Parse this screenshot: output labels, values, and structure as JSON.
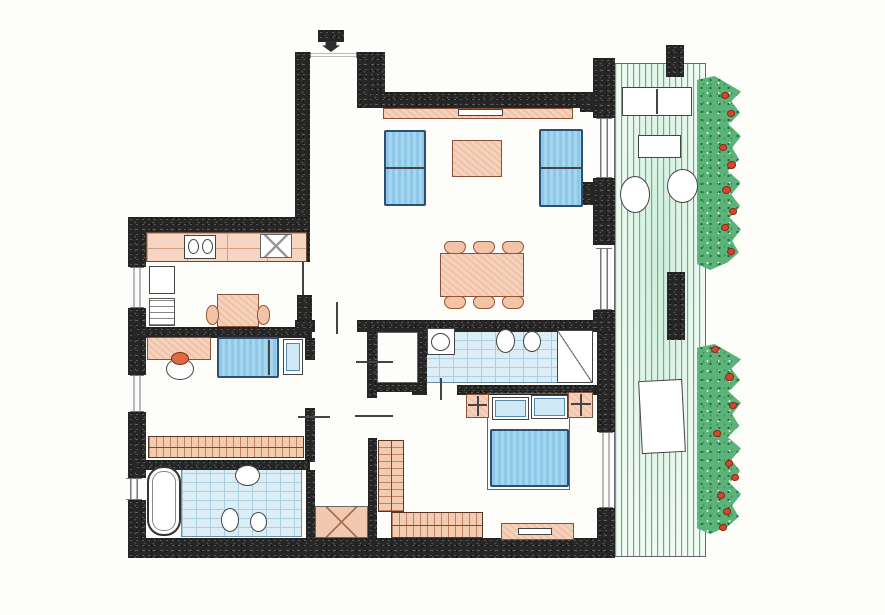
{
  "meta": {
    "title": "apartment-floor-plan",
    "canvas": {
      "width": 885,
      "height": 615
    }
  },
  "palette": {
    "paper": "#fdfdfa",
    "wall": "#262626",
    "furniture_peach": "#f6d2bc",
    "furniture_peach_border": "#8a5138",
    "upholstery_blue": "#a3d6ef",
    "upholstery_blue_border": "#2e4f74",
    "tile_blue": "#dcedf6",
    "tile_line": "#a9cfe0",
    "deck_green": "#2f9e6a",
    "hedge_green": "#5cb37a",
    "flower_red": "#d5472e",
    "glazing_gray": "#777777"
  },
  "rooms": [
    {
      "name": "entry-hall"
    },
    {
      "name": "living-dining-room"
    },
    {
      "name": "kitchen"
    },
    {
      "name": "bedroom-1"
    },
    {
      "name": "bathroom-1"
    },
    {
      "name": "hallway"
    },
    {
      "name": "closet"
    },
    {
      "name": "bathroom-2"
    },
    {
      "name": "bedroom-2"
    },
    {
      "name": "terrace"
    }
  ],
  "elements": [
    {
      "name": "terrace-deck",
      "type": "deck",
      "x": 614,
      "y": 63,
      "w": 92,
      "h": 494
    },
    {
      "name": "hedge-upper",
      "type": "hedge",
      "x": 697,
      "y": 76,
      "w": 44,
      "h": 194
    },
    {
      "name": "hedge-lower",
      "type": "hedge",
      "x": 697,
      "y": 344,
      "w": 44,
      "h": 190
    },
    {
      "name": "bathroom1-tile-floor",
      "type": "tiles",
      "x": 181,
      "y": 463,
      "w": 121,
      "h": 74
    },
    {
      "name": "bathroom2-tile-floor",
      "type": "tiles",
      "x": 424,
      "y": 330,
      "w": 137,
      "h": 53
    },
    {
      "name": "closet-floor",
      "type": "outline-thin",
      "x": 377,
      "y": 332,
      "w": 41,
      "h": 51
    },
    {
      "name": "hall-storage-x-area",
      "type": "peach-x",
      "x": 315,
      "y": 506,
      "w": 53,
      "h": 32
    },
    {
      "name": "wall-entry-left",
      "type": "wall",
      "x": 295,
      "y": 52,
      "w": 15,
      "h": 178
    },
    {
      "name": "wall-entrance-right-pillar",
      "type": "wall",
      "x": 357,
      "y": 52,
      "w": 28,
      "h": 56
    },
    {
      "name": "wall-living-top",
      "type": "wall",
      "x": 368,
      "y": 92,
      "w": 227,
      "h": 16
    },
    {
      "name": "wall-terrace-pillar-a",
      "type": "wall",
      "x": 593,
      "y": 58,
      "w": 22,
      "h": 60
    },
    {
      "name": "wall-terrace-pillar-a-stub",
      "type": "wall",
      "x": 580,
      "y": 92,
      "w": 13,
      "h": 20
    },
    {
      "name": "wall-terrace-pillar-b",
      "type": "wall",
      "x": 593,
      "y": 178,
      "w": 22,
      "h": 67
    },
    {
      "name": "wall-terrace-pillar-b-stub",
      "type": "wall",
      "x": 580,
      "y": 182,
      "w": 13,
      "h": 23
    },
    {
      "name": "wall-terrace-pillar-c",
      "type": "wall",
      "x": 593,
      "y": 310,
      "w": 22,
      "h": 22
    },
    {
      "name": "wall-kitchen-top",
      "type": "wall",
      "x": 128,
      "y": 217,
      "w": 182,
      "h": 15
    },
    {
      "name": "wall-left-1",
      "type": "wall",
      "x": 128,
      "y": 217,
      "w": 18,
      "h": 50
    },
    {
      "name": "wall-left-2",
      "type": "wall",
      "x": 128,
      "y": 308,
      "w": 18,
      "h": 67
    },
    {
      "name": "wall-left-3",
      "type": "wall",
      "x": 128,
      "y": 412,
      "w": 18,
      "h": 66
    },
    {
      "name": "wall-left-4",
      "type": "wall",
      "x": 128,
      "y": 500,
      "w": 18,
      "h": 58
    },
    {
      "name": "wall-kitchen-east-upper",
      "type": "wall",
      "x": 295,
      "y": 230,
      "w": 15,
      "h": 32
    },
    {
      "name": "wall-kitchen-east-lower",
      "type": "wall",
      "x": 297,
      "y": 295,
      "w": 15,
      "h": 32
    },
    {
      "name": "wall-kitchen-divider",
      "type": "wall",
      "x": 135,
      "y": 327,
      "w": 177,
      "h": 11
    },
    {
      "name": "wall-hall-top-left",
      "type": "wall",
      "x": 295,
      "y": 320,
      "w": 20,
      "h": 12
    },
    {
      "name": "wall-hall-top-right",
      "type": "wall",
      "x": 357,
      "y": 320,
      "w": 238,
      "h": 12
    },
    {
      "name": "wall-hall-left-upper",
      "type": "wall",
      "x": 305,
      "y": 338,
      "w": 10,
      "h": 22
    },
    {
      "name": "wall-hall-left-mid",
      "type": "wall",
      "x": 305,
      "y": 408,
      "w": 10,
      "h": 54
    },
    {
      "name": "wall-bathroom1-top",
      "type": "wall",
      "x": 135,
      "y": 460,
      "w": 175,
      "h": 10
    },
    {
      "name": "wall-bathroom1-right",
      "type": "wall",
      "x": 306,
      "y": 470,
      "w": 9,
      "h": 68
    },
    {
      "name": "wall-closet-left",
      "type": "wall",
      "x": 367,
      "y": 332,
      "w": 10,
      "h": 66
    },
    {
      "name": "wall-closet-bottom",
      "type": "wall",
      "x": 372,
      "y": 383,
      "w": 50,
      "h": 9
    },
    {
      "name": "wall-closet-right",
      "type": "wall",
      "x": 418,
      "y": 325,
      "w": 9,
      "h": 62
    },
    {
      "name": "wall-hall-right-lower",
      "type": "wall",
      "x": 368,
      "y": 438,
      "w": 9,
      "h": 100
    },
    {
      "name": "wall-bath2-bottom-left",
      "type": "wall",
      "x": 412,
      "y": 383,
      "w": 15,
      "h": 12
    },
    {
      "name": "wall-bath2-bottom-right",
      "type": "wall",
      "x": 457,
      "y": 385,
      "w": 140,
      "h": 10
    },
    {
      "name": "wall-right-lower-1",
      "type": "wall",
      "x": 597,
      "y": 332,
      "w": 18,
      "h": 100
    },
    {
      "name": "wall-right-lower-2",
      "type": "wall",
      "x": 597,
      "y": 508,
      "w": 18,
      "h": 50
    },
    {
      "name": "wall-bottom",
      "type": "wall",
      "x": 128,
      "y": 538,
      "w": 487,
      "h": 20
    },
    {
      "name": "wall-terrace-pillar-top",
      "type": "wall",
      "x": 666,
      "y": 45,
      "w": 18,
      "h": 32
    },
    {
      "name": "wall-terrace-pillar-mid",
      "type": "wall",
      "x": 667,
      "y": 272,
      "w": 18,
      "h": 68
    },
    {
      "name": "entrance-hatch-mark",
      "type": "wall",
      "x": 318,
      "y": 30,
      "w": 26,
      "h": 12
    },
    {
      "name": "kitchen-window",
      "type": "window-v",
      "x": 130,
      "y": 267,
      "w": 14,
      "h": 41
    },
    {
      "name": "bedroom1-window",
      "type": "window-v",
      "x": 130,
      "y": 375,
      "w": 14,
      "h": 37
    },
    {
      "name": "bathroom1-window",
      "type": "window-v",
      "x": 126,
      "y": 478,
      "w": 16,
      "h": 22
    },
    {
      "name": "living-terrace-door-1",
      "type": "window-v",
      "x": 596,
      "y": 118,
      "w": 16,
      "h": 60
    },
    {
      "name": "living-terrace-door-2",
      "type": "window-v",
      "x": 596,
      "y": 248,
      "w": 16,
      "h": 62
    },
    {
      "name": "bedroom2-window",
      "type": "window-v",
      "x": 599,
      "y": 432,
      "w": 14,
      "h": 76
    },
    {
      "name": "entrance-threshold",
      "type": "window-h",
      "x": 310,
      "y": 52,
      "w": 47,
      "h": 6
    },
    {
      "name": "kitchen-door-leaf",
      "type": "line-v",
      "x": 302,
      "y": 262,
      "w": 2,
      "h": 33
    },
    {
      "name": "entrance-arrow",
      "type": "arrow",
      "x": 322,
      "y": 41,
      "w": 18,
      "h": 11
    },
    {
      "name": "sideboard",
      "type": "peach",
      "x": 383,
      "y": 108,
      "w": 190,
      "h": 11
    },
    {
      "name": "sideboard-inset",
      "type": "white-rect",
      "x": 458,
      "y": 109,
      "w": 45,
      "h": 7
    },
    {
      "name": "sofa-left",
      "type": "blue",
      "x": 384,
      "y": 130,
      "w": 42,
      "h": 76
    },
    {
      "name": "sofa-left-seam",
      "type": "line-h",
      "x": 386,
      "y": 167,
      "w": 38,
      "h": 2
    },
    {
      "name": "sofa-right",
      "type": "blue",
      "x": 539,
      "y": 129,
      "w": 44,
      "h": 78
    },
    {
      "name": "sofa-right-seam",
      "type": "line-h",
      "x": 541,
      "y": 167,
      "w": 40,
      "h": 2
    },
    {
      "name": "coffee-table",
      "type": "peach",
      "x": 452,
      "y": 140,
      "w": 50,
      "h": 37
    },
    {
      "name": "dining-table",
      "type": "peach",
      "x": 440,
      "y": 253,
      "w": 84,
      "h": 44
    },
    {
      "name": "dining-chair-1",
      "type": "chair",
      "x": 444,
      "y": 241,
      "w": 22,
      "h": 13
    },
    {
      "name": "dining-chair-2",
      "type": "chair",
      "x": 473,
      "y": 241,
      "w": 22,
      "h": 13
    },
    {
      "name": "dining-chair-3",
      "type": "chair",
      "x": 502,
      "y": 241,
      "w": 22,
      "h": 13
    },
    {
      "name": "dining-chair-4",
      "type": "chair",
      "x": 444,
      "y": 296,
      "w": 22,
      "h": 13
    },
    {
      "name": "dining-chair-5",
      "type": "chair",
      "x": 473,
      "y": 296,
      "w": 22,
      "h": 13
    },
    {
      "name": "dining-chair-6",
      "type": "chair",
      "x": 502,
      "y": 296,
      "w": 22,
      "h": 13
    },
    {
      "name": "kitchen-counter",
      "type": "counter",
      "x": 146,
      "y": 232,
      "w": 161,
      "h": 30
    },
    {
      "name": "kitchen-sink-unit",
      "type": "white-rect",
      "x": 184,
      "y": 235,
      "w": 32,
      "h": 24
    },
    {
      "name": "kitchen-sink-basin-1",
      "type": "round",
      "x": 188,
      "y": 239,
      "w": 11,
      "h": 15
    },
    {
      "name": "kitchen-sink-basin-2",
      "type": "round",
      "x": 202,
      "y": 239,
      "w": 11,
      "h": 15
    },
    {
      "name": "kitchen-hob",
      "type": "xbox",
      "x": 260,
      "y": 234,
      "w": 32,
      "h": 24
    },
    {
      "name": "kitchen-fridge",
      "type": "white-rect",
      "x": 149,
      "y": 266,
      "w": 26,
      "h": 28
    },
    {
      "name": "kitchen-appliance-stack",
      "type": "stripes",
      "x": 149,
      "y": 298,
      "w": 26,
      "h": 28
    },
    {
      "name": "kitchen-table",
      "type": "peach",
      "x": 217,
      "y": 294,
      "w": 42,
      "h": 33
    },
    {
      "name": "kitchen-chair-left",
      "type": "chair-round",
      "x": 206,
      "y": 305,
      "w": 13,
      "h": 20
    },
    {
      "name": "kitchen-chair-right",
      "type": "chair-round",
      "x": 257,
      "y": 305,
      "w": 13,
      "h": 20
    },
    {
      "name": "bedroom1-desk",
      "type": "peach",
      "x": 147,
      "y": 337,
      "w": 64,
      "h": 23
    },
    {
      "name": "bedroom1-side-table",
      "type": "round",
      "x": 166,
      "y": 358,
      "w": 28,
      "h": 22
    },
    {
      "name": "bedroom1-desk-chair",
      "type": "orange-seat",
      "x": 171,
      "y": 352,
      "w": 18,
      "h": 13
    },
    {
      "name": "bedroom1-bed",
      "type": "blue",
      "x": 217,
      "y": 337,
      "w": 62,
      "h": 41
    },
    {
      "name": "bedroom1-bed-headboard",
      "type": "line-v",
      "x": 268,
      "y": 340,
      "w": 2,
      "h": 35
    },
    {
      "name": "bedroom1-nightstand",
      "type": "white-rect",
      "x": 283,
      "y": 339,
      "w": 20,
      "h": 36
    },
    {
      "name": "bedroom1-nightstand-inset",
      "type": "blue-light",
      "x": 286,
      "y": 343,
      "w": 14,
      "h": 28
    },
    {
      "name": "bedroom1-wardrobe",
      "type": "peach-hatch",
      "x": 148,
      "y": 436,
      "w": 156,
      "h": 22
    },
    {
      "name": "bathtub",
      "type": "tub",
      "x": 147,
      "y": 466,
      "w": 34,
      "h": 70
    },
    {
      "name": "bathroom1-sink",
      "type": "round",
      "x": 235,
      "y": 465,
      "w": 25,
      "h": 21
    },
    {
      "name": "bathroom1-toilet",
      "type": "round",
      "x": 221,
      "y": 508,
      "w": 18,
      "h": 24
    },
    {
      "name": "bathroom1-bidet",
      "type": "round",
      "x": 250,
      "y": 512,
      "w": 17,
      "h": 20
    },
    {
      "name": "hall-door-mark-1",
      "type": "line-v",
      "x": 336,
      "y": 302,
      "w": 2,
      "h": 32
    },
    {
      "name": "hall-door-mark-2",
      "type": "line-h",
      "x": 356,
      "y": 361,
      "w": 37,
      "h": 2
    },
    {
      "name": "hall-door-mark-3",
      "type": "line-h",
      "x": 355,
      "y": 415,
      "w": 38,
      "h": 2
    },
    {
      "name": "hall-door-mark-4",
      "type": "line-h",
      "x": 298,
      "y": 416,
      "w": 32,
      "h": 2
    },
    {
      "name": "bathroom2-sink-unit",
      "type": "white-rect",
      "x": 427,
      "y": 328,
      "w": 28,
      "h": 27
    },
    {
      "name": "bathroom2-sink",
      "type": "round",
      "x": 431,
      "y": 333,
      "w": 19,
      "h": 18
    },
    {
      "name": "bathroom2-toilet",
      "type": "round",
      "x": 496,
      "y": 329,
      "w": 19,
      "h": 24
    },
    {
      "name": "bathroom2-bidet",
      "type": "round",
      "x": 523,
      "y": 331,
      "w": 18,
      "h": 21
    },
    {
      "name": "bathroom2-shower",
      "type": "shower",
      "x": 557,
      "y": 330,
      "w": 36,
      "h": 53
    },
    {
      "name": "bathroom2-door-leaf",
      "type": "line-v",
      "x": 440,
      "y": 378,
      "w": 2,
      "h": 22
    },
    {
      "name": "bedroom2-bed-frame",
      "type": "outline-thin",
      "x": 487,
      "y": 393,
      "w": 83,
      "h": 97
    },
    {
      "name": "bedroom2-pillow-left",
      "type": "white-rect",
      "x": 492,
      "y": 397,
      "w": 37,
      "h": 23
    },
    {
      "name": "bedroom2-pillow-left-inset",
      "type": "blue-light",
      "x": 495,
      "y": 400,
      "w": 31,
      "h": 17
    },
    {
      "name": "bedroom2-pillow-right",
      "type": "white-rect",
      "x": 531,
      "y": 395,
      "w": 37,
      "h": 24
    },
    {
      "name": "bedroom2-pillow-right-inset",
      "type": "blue-light",
      "x": 534,
      "y": 398,
      "w": 31,
      "h": 18
    },
    {
      "name": "bedroom2-duvet",
      "type": "blue",
      "x": 490,
      "y": 429,
      "w": 79,
      "h": 58
    },
    {
      "name": "bedroom2-nightstand-left",
      "type": "peach",
      "x": 466,
      "y": 394,
      "w": 23,
      "h": 24
    },
    {
      "name": "bedroom2-lamp-left-v",
      "type": "line-v",
      "x": 477,
      "y": 396,
      "w": 2,
      "h": 20
    },
    {
      "name": "bedroom2-lamp-left-h",
      "type": "line-h",
      "x": 468,
      "y": 404,
      "w": 19,
      "h": 2
    },
    {
      "name": "bedroom2-nightstand-right",
      "type": "peach",
      "x": 568,
      "y": 392,
      "w": 25,
      "h": 26
    },
    {
      "name": "bedroom2-lamp-right-v",
      "type": "line-v",
      "x": 580,
      "y": 394,
      "w": 2,
      "h": 22
    },
    {
      "name": "bedroom2-lamp-right-h",
      "type": "line-h",
      "x": 571,
      "y": 403,
      "w": 20,
      "h": 2
    },
    {
      "name": "bedroom2-wardrobe-vertical",
      "type": "peach-hatch-v",
      "x": 378,
      "y": 440,
      "w": 26,
      "h": 72
    },
    {
      "name": "bedroom2-wardrobe-horizontal",
      "type": "peach-hatch",
      "x": 391,
      "y": 512,
      "w": 92,
      "h": 26
    },
    {
      "name": "bedroom2-bench",
      "type": "peach",
      "x": 501,
      "y": 523,
      "w": 73,
      "h": 17
    },
    {
      "name": "bedroom2-bench-inset",
      "type": "white-rect",
      "x": 518,
      "y": 528,
      "w": 34,
      "h": 7
    },
    {
      "name": "terrace-bench",
      "type": "white-rect",
      "x": 622,
      "y": 87,
      "w": 70,
      "h": 29
    },
    {
      "name": "terrace-bench-divider",
      "type": "line-v",
      "x": 656,
      "y": 89,
      "w": 2,
      "h": 25
    },
    {
      "name": "terrace-table-upper",
      "type": "white-rect",
      "x": 638,
      "y": 135,
      "w": 43,
      "h": 23
    },
    {
      "name": "terrace-chair-1",
      "type": "round",
      "x": 620,
      "y": 176,
      "w": 30,
      "h": 37
    },
    {
      "name": "terrace-chair-2",
      "type": "round",
      "x": 667,
      "y": 169,
      "w": 31,
      "h": 34
    },
    {
      "name": "terrace-table-lower",
      "type": "white-rect",
      "x": 640,
      "y": 380,
      "w": 44,
      "h": 73,
      "rot": -3
    },
    {
      "name": "flower",
      "type": "flower",
      "x": 721,
      "y": 92,
      "w": 8,
      "h": 7
    },
    {
      "name": "flower",
      "type": "flower",
      "x": 727,
      "y": 110,
      "w": 8,
      "h": 7
    },
    {
      "name": "flower",
      "type": "flower",
      "x": 719,
      "y": 144,
      "w": 8,
      "h": 7
    },
    {
      "name": "flower",
      "type": "flower",
      "x": 727,
      "y": 161,
      "w": 9,
      "h": 8
    },
    {
      "name": "flower",
      "type": "flower",
      "x": 722,
      "y": 186,
      "w": 9,
      "h": 8
    },
    {
      "name": "flower",
      "type": "flower",
      "x": 729,
      "y": 208,
      "w": 8,
      "h": 7
    },
    {
      "name": "flower",
      "type": "flower",
      "x": 721,
      "y": 224,
      "w": 8,
      "h": 7
    },
    {
      "name": "flower",
      "type": "flower",
      "x": 727,
      "y": 248,
      "w": 8,
      "h": 7
    },
    {
      "name": "flower",
      "type": "flower",
      "x": 711,
      "y": 346,
      "w": 8,
      "h": 7
    },
    {
      "name": "flower",
      "type": "flower",
      "x": 725,
      "y": 373,
      "w": 9,
      "h": 8
    },
    {
      "name": "flower",
      "type": "flower",
      "x": 729,
      "y": 402,
      "w": 8,
      "h": 7
    },
    {
      "name": "flower",
      "type": "flower",
      "x": 713,
      "y": 430,
      "w": 8,
      "h": 7
    },
    {
      "name": "flower",
      "type": "flower",
      "x": 725,
      "y": 460,
      "w": 8,
      "h": 7
    },
    {
      "name": "flower",
      "type": "flower",
      "x": 731,
      "y": 474,
      "w": 8,
      "h": 7
    },
    {
      "name": "flower",
      "type": "flower",
      "x": 717,
      "y": 492,
      "w": 8,
      "h": 7
    },
    {
      "name": "flower",
      "type": "flower",
      "x": 723,
      "y": 508,
      "w": 8,
      "h": 7
    },
    {
      "name": "flower",
      "type": "flower",
      "x": 719,
      "y": 524,
      "w": 8,
      "h": 7
    }
  ]
}
